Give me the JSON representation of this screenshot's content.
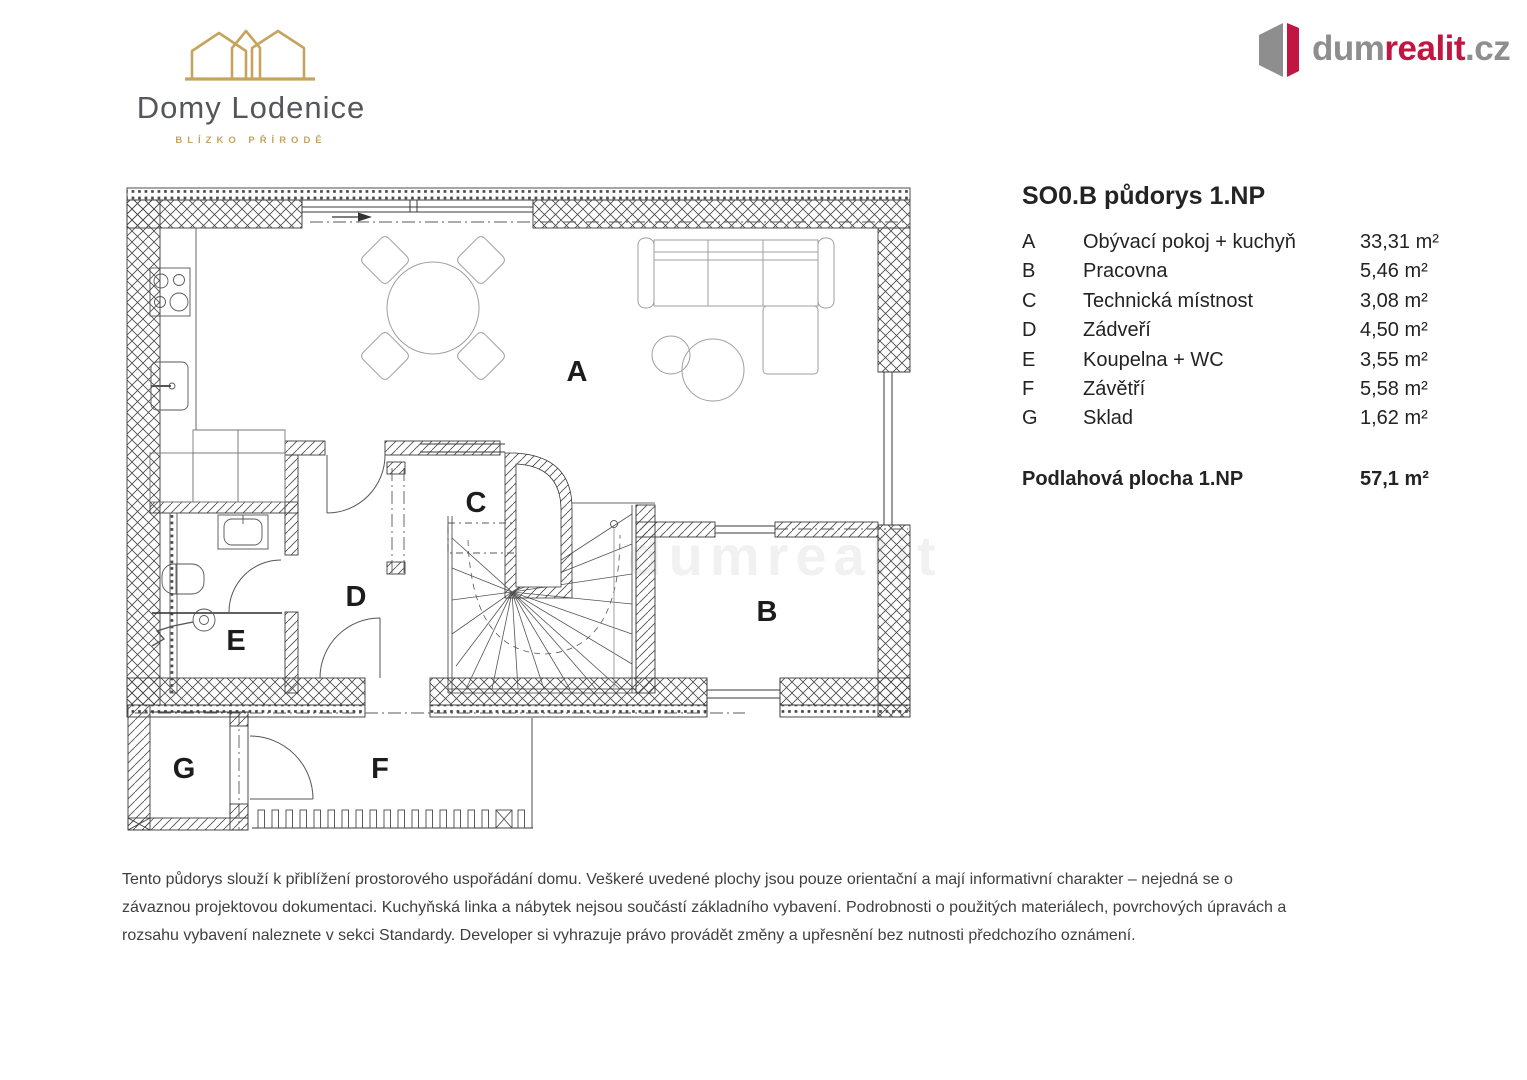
{
  "header": {
    "developer": {
      "name": "Domy Lodenice",
      "tagline": "BLÍZKO PŘÍRODĚ",
      "logo_gold": "#c6a45f",
      "text_gray": "#55565a"
    },
    "agency": {
      "prefix": "dum",
      "highlight": "realit",
      "suffix": ".cz",
      "gray_color": "#8e8e8e",
      "red_color": "#c11641"
    }
  },
  "legend": {
    "title": "SO0.B půdorys 1.NP",
    "rooms": [
      {
        "key": "A",
        "name": "Obývací pokoj + kuchyň",
        "area": "33,31 m²"
      },
      {
        "key": "B",
        "name": "Pracovna",
        "area": "5,46 m²"
      },
      {
        "key": "C",
        "name": "Technická místnost",
        "area": "3,08 m²"
      },
      {
        "key": "D",
        "name": "Zádveří",
        "area": "4,50 m²"
      },
      {
        "key": "E",
        "name": "Koupelna + WC",
        "area": "3,55 m²"
      },
      {
        "key": "F",
        "name": "Závětří",
        "area": "5,58 m²"
      },
      {
        "key": "G",
        "name": "Sklad",
        "area": "1,62 m²"
      }
    ],
    "total_label": "Podlahová plocha 1.NP",
    "total_area": "57,1 m²"
  },
  "floorplan": {
    "room_labels": [
      "A",
      "B",
      "C",
      "D",
      "E",
      "F",
      "G"
    ],
    "watermark": "dumrealit"
  },
  "disclaimer": {
    "lines": [
      "Tento půdorys slouží k přiblížení prostorového uspořádání domu. Veškeré uvedené plochy jsou pouze orientační a mají informativní charakter – nejedná se o",
      "závaznou projektovou dokumentaci. Kuchyňská linka a nábytek nejsou součástí základního vybavení. Podrobnosti o použitých materiálech, povrchových úpravách a",
      "rozsahu vybavení naleznete v sekci Standardy. Developer si vyhrazuje právo provádět změny a upřesnění bez nutnosti předchozího oznámení."
    ]
  }
}
